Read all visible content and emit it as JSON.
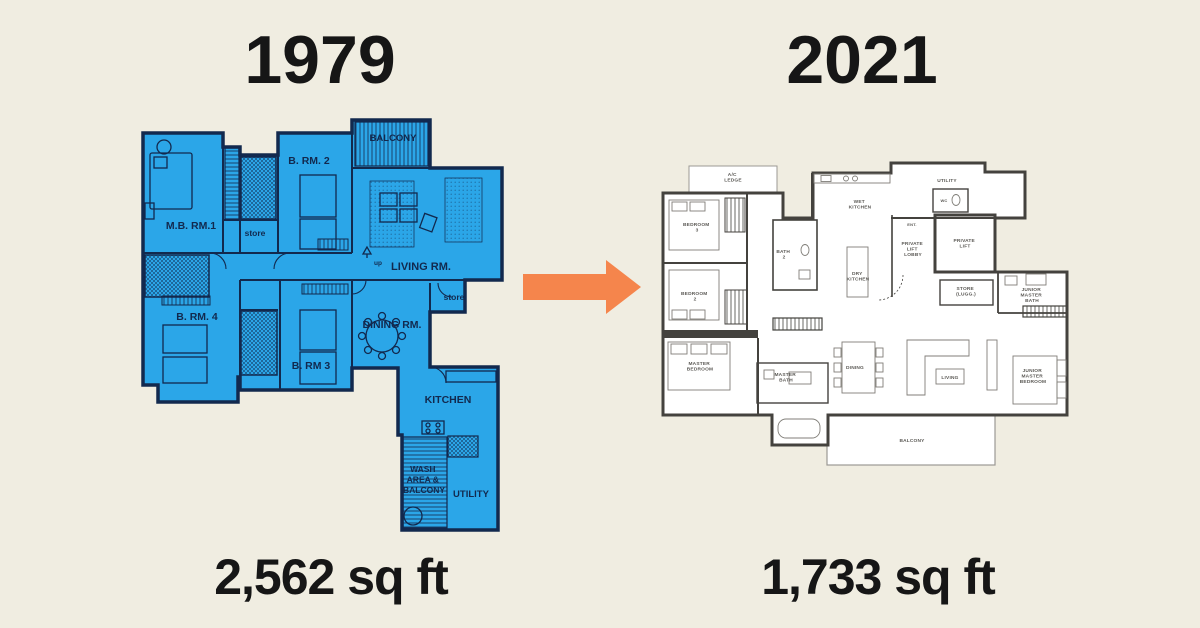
{
  "page": {
    "background_color": "#F0EDE1"
  },
  "comparison": {
    "left": {
      "year": "1979",
      "area": "2,562 sq ft"
    },
    "right": {
      "year": "2021",
      "area": "1,733 sq ft"
    }
  },
  "arrow": {
    "direction": "right",
    "color": "#F5854C"
  },
  "plan_1979": {
    "fill_color": "#2BA6E8",
    "line_color": "#12294E",
    "rooms": {
      "mbr": "M.B. RM.1",
      "brm2": "B. RM. 2",
      "balcony": "BALCONY",
      "store_left": "store",
      "living": "LIVING RM.",
      "up": "up",
      "store_right": "store",
      "dining": "DINING RM.",
      "brm4": "B. RM. 4",
      "brm3": "B. RM 3",
      "kitchen": "KITCHEN",
      "wash": [
        "WASH",
        "AREA &",
        "BALCONY"
      ],
      "utility": "UTILITY"
    }
  },
  "plan_2021": {
    "wall_color": "#44423E",
    "rooms": {
      "ac_ledge": [
        "A/C",
        "LEDGE"
      ],
      "bedroom3": [
        "BEDROOM",
        "3"
      ],
      "bedroom2": [
        "BEDROOM",
        "2"
      ],
      "master_bedroom": [
        "MASTER",
        "BEDROOM"
      ],
      "bath2": [
        "BATH",
        "2"
      ],
      "wet_kitchen": [
        "WET",
        "KITCHEN"
      ],
      "dry_kitchen": [
        "DRY",
        "KITCHEN"
      ],
      "utility": "UTILITY",
      "wc": "WC",
      "ent": "ENT.",
      "private_lift": [
        "PRIVATE",
        "LIFT"
      ],
      "private_lift_lobby": [
        "PRIVATE",
        "LIFT",
        "LOBBY"
      ],
      "store": [
        "STORE",
        "(LUGG.)"
      ],
      "junior_master_bath": [
        "JUNIOR",
        "MASTER",
        "BATH"
      ],
      "junior_master_bedroom": [
        "JUNIOR",
        "MASTER",
        "BEDROOM"
      ],
      "master_bath": [
        "MASTER",
        "BATH"
      ],
      "dining": "DINING",
      "living": "LIVING",
      "balcony": "BALCONY"
    }
  }
}
